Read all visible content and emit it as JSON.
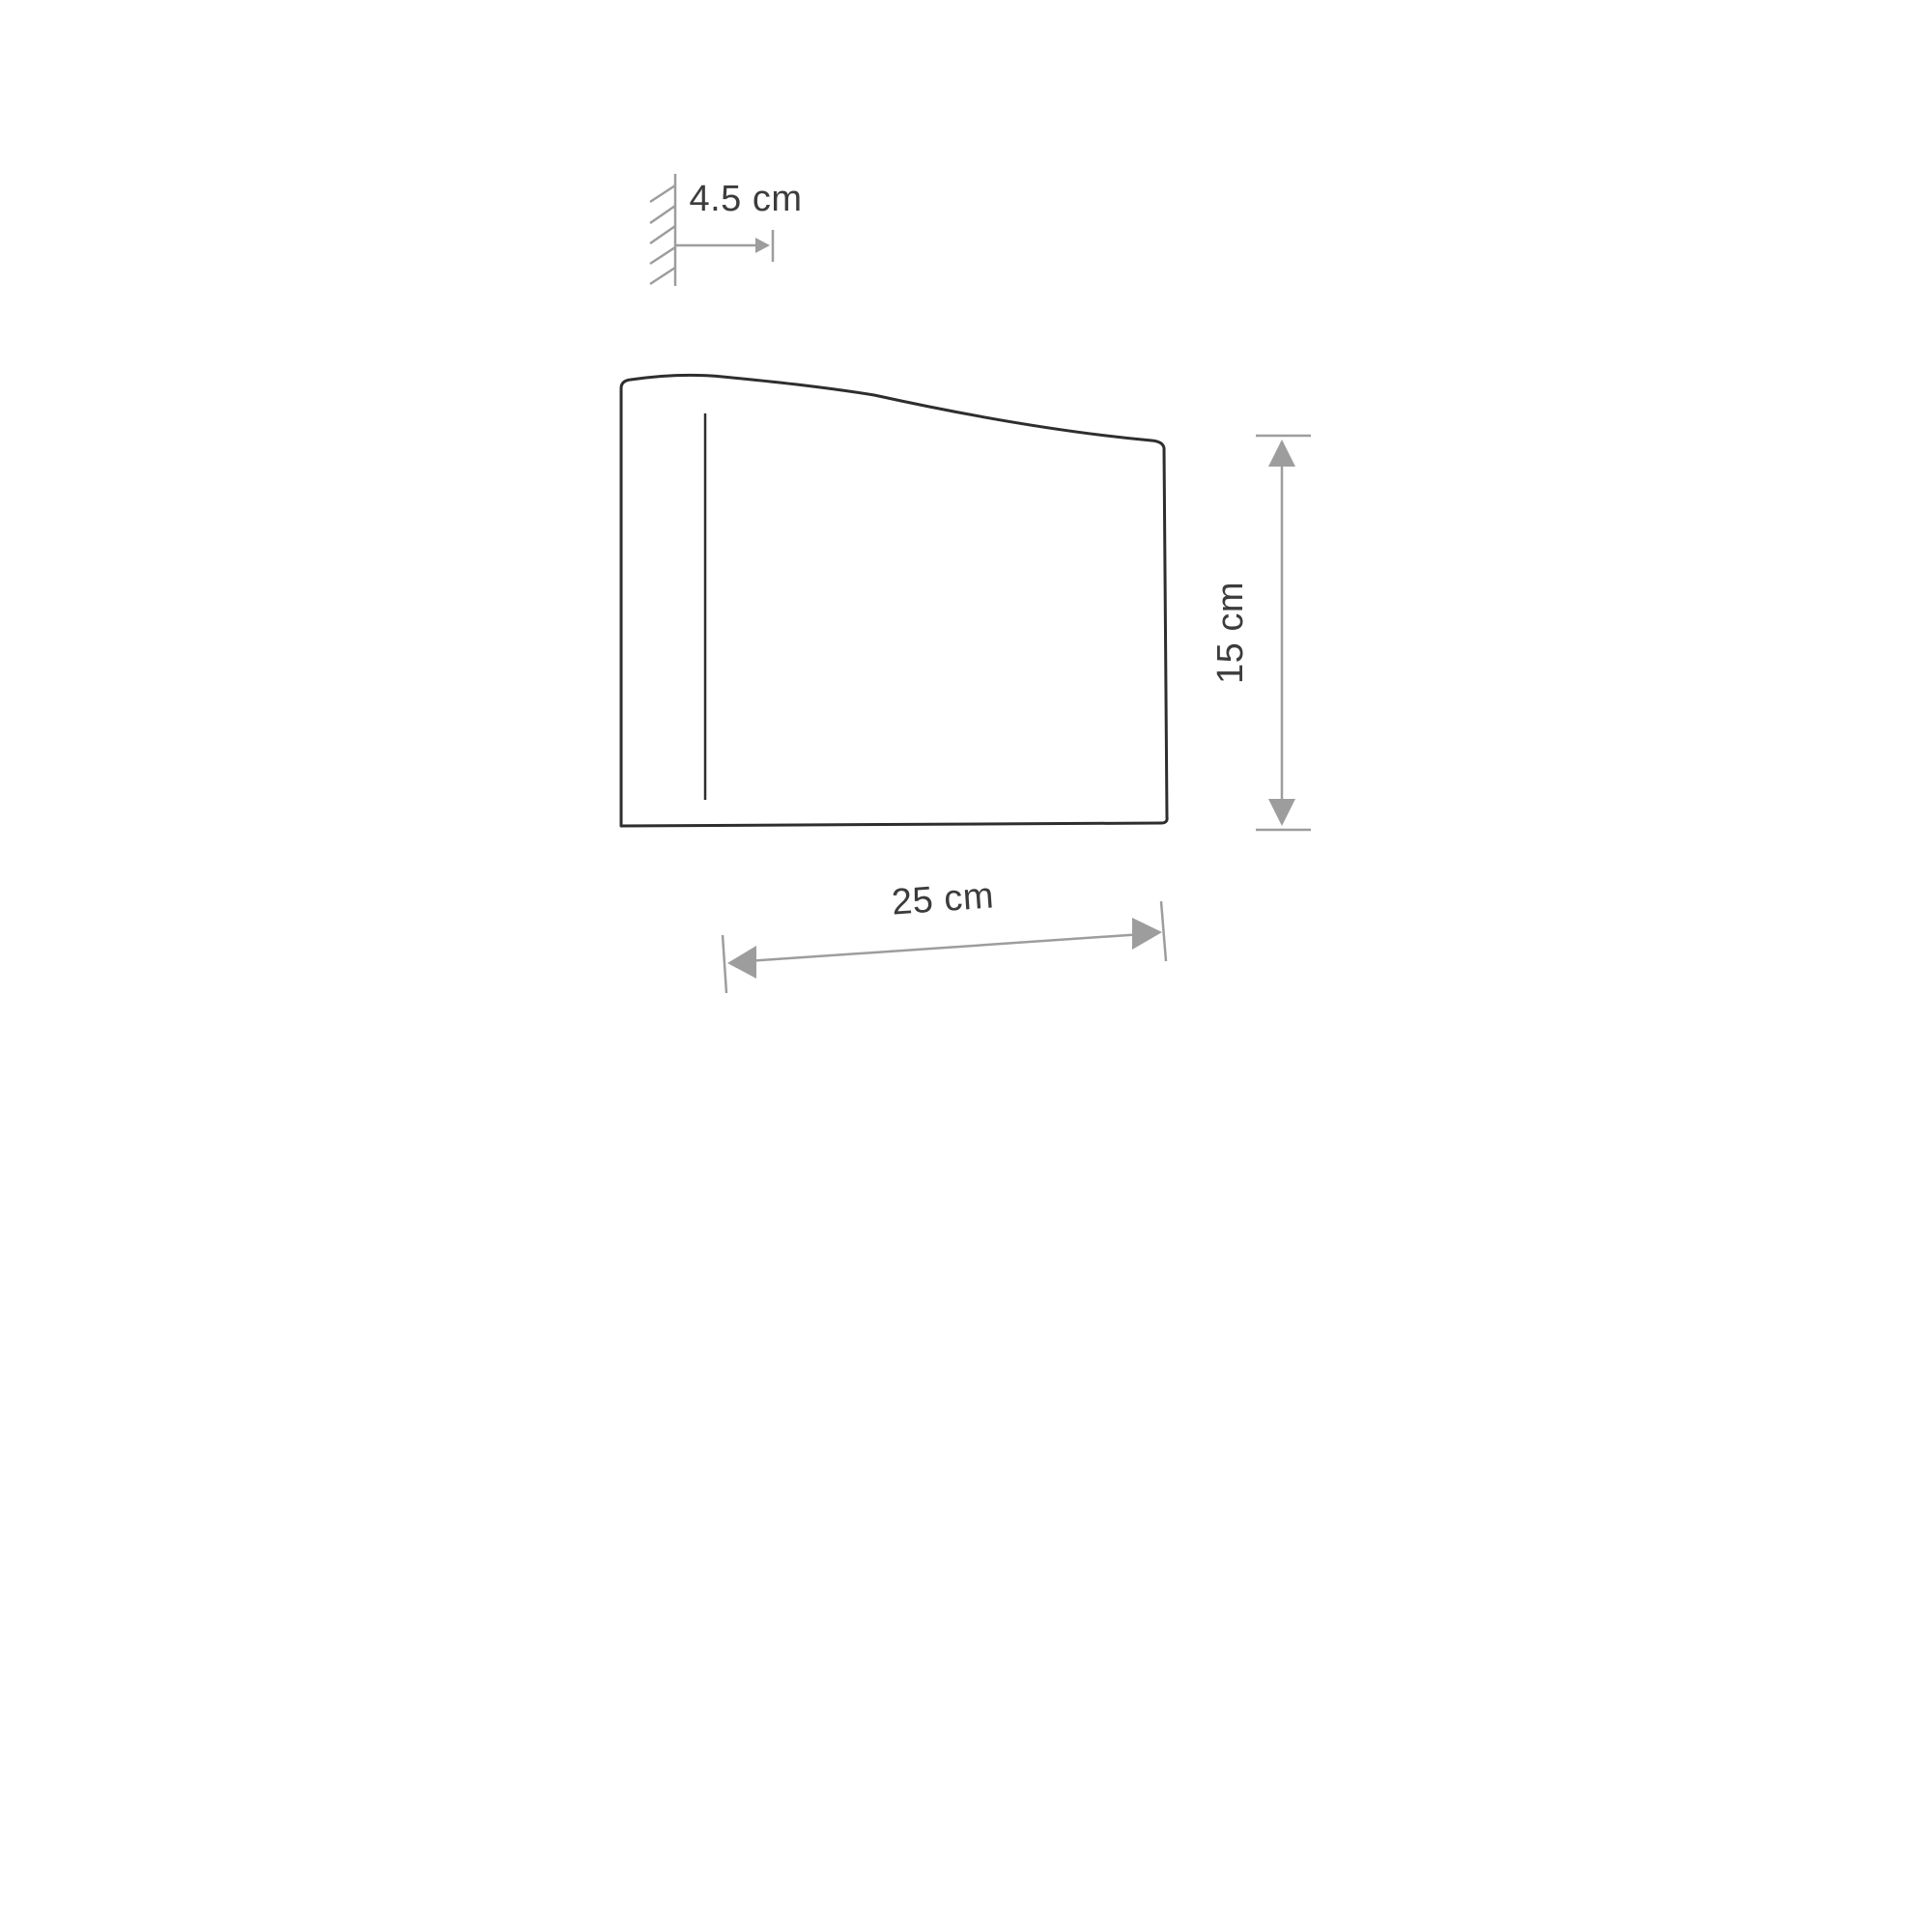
{
  "page": {
    "background": "#ffffff"
  },
  "drawing": {
    "title": "wall-lamp-side-profile-dimension-drawing",
    "colors": {
      "outline": "#2e2e2e",
      "dimension_lines": "#9d9d9d",
      "label_text": "#3c3c3c"
    },
    "dimensions": {
      "wall_offset": {
        "label": "4.5 cm",
        "value": 4.5,
        "unit": "cm"
      },
      "width": {
        "label": "25 cm",
        "value": 25,
        "unit": "cm"
      },
      "height": {
        "label": "15 cm",
        "value": 15,
        "unit": "cm"
      }
    }
  }
}
